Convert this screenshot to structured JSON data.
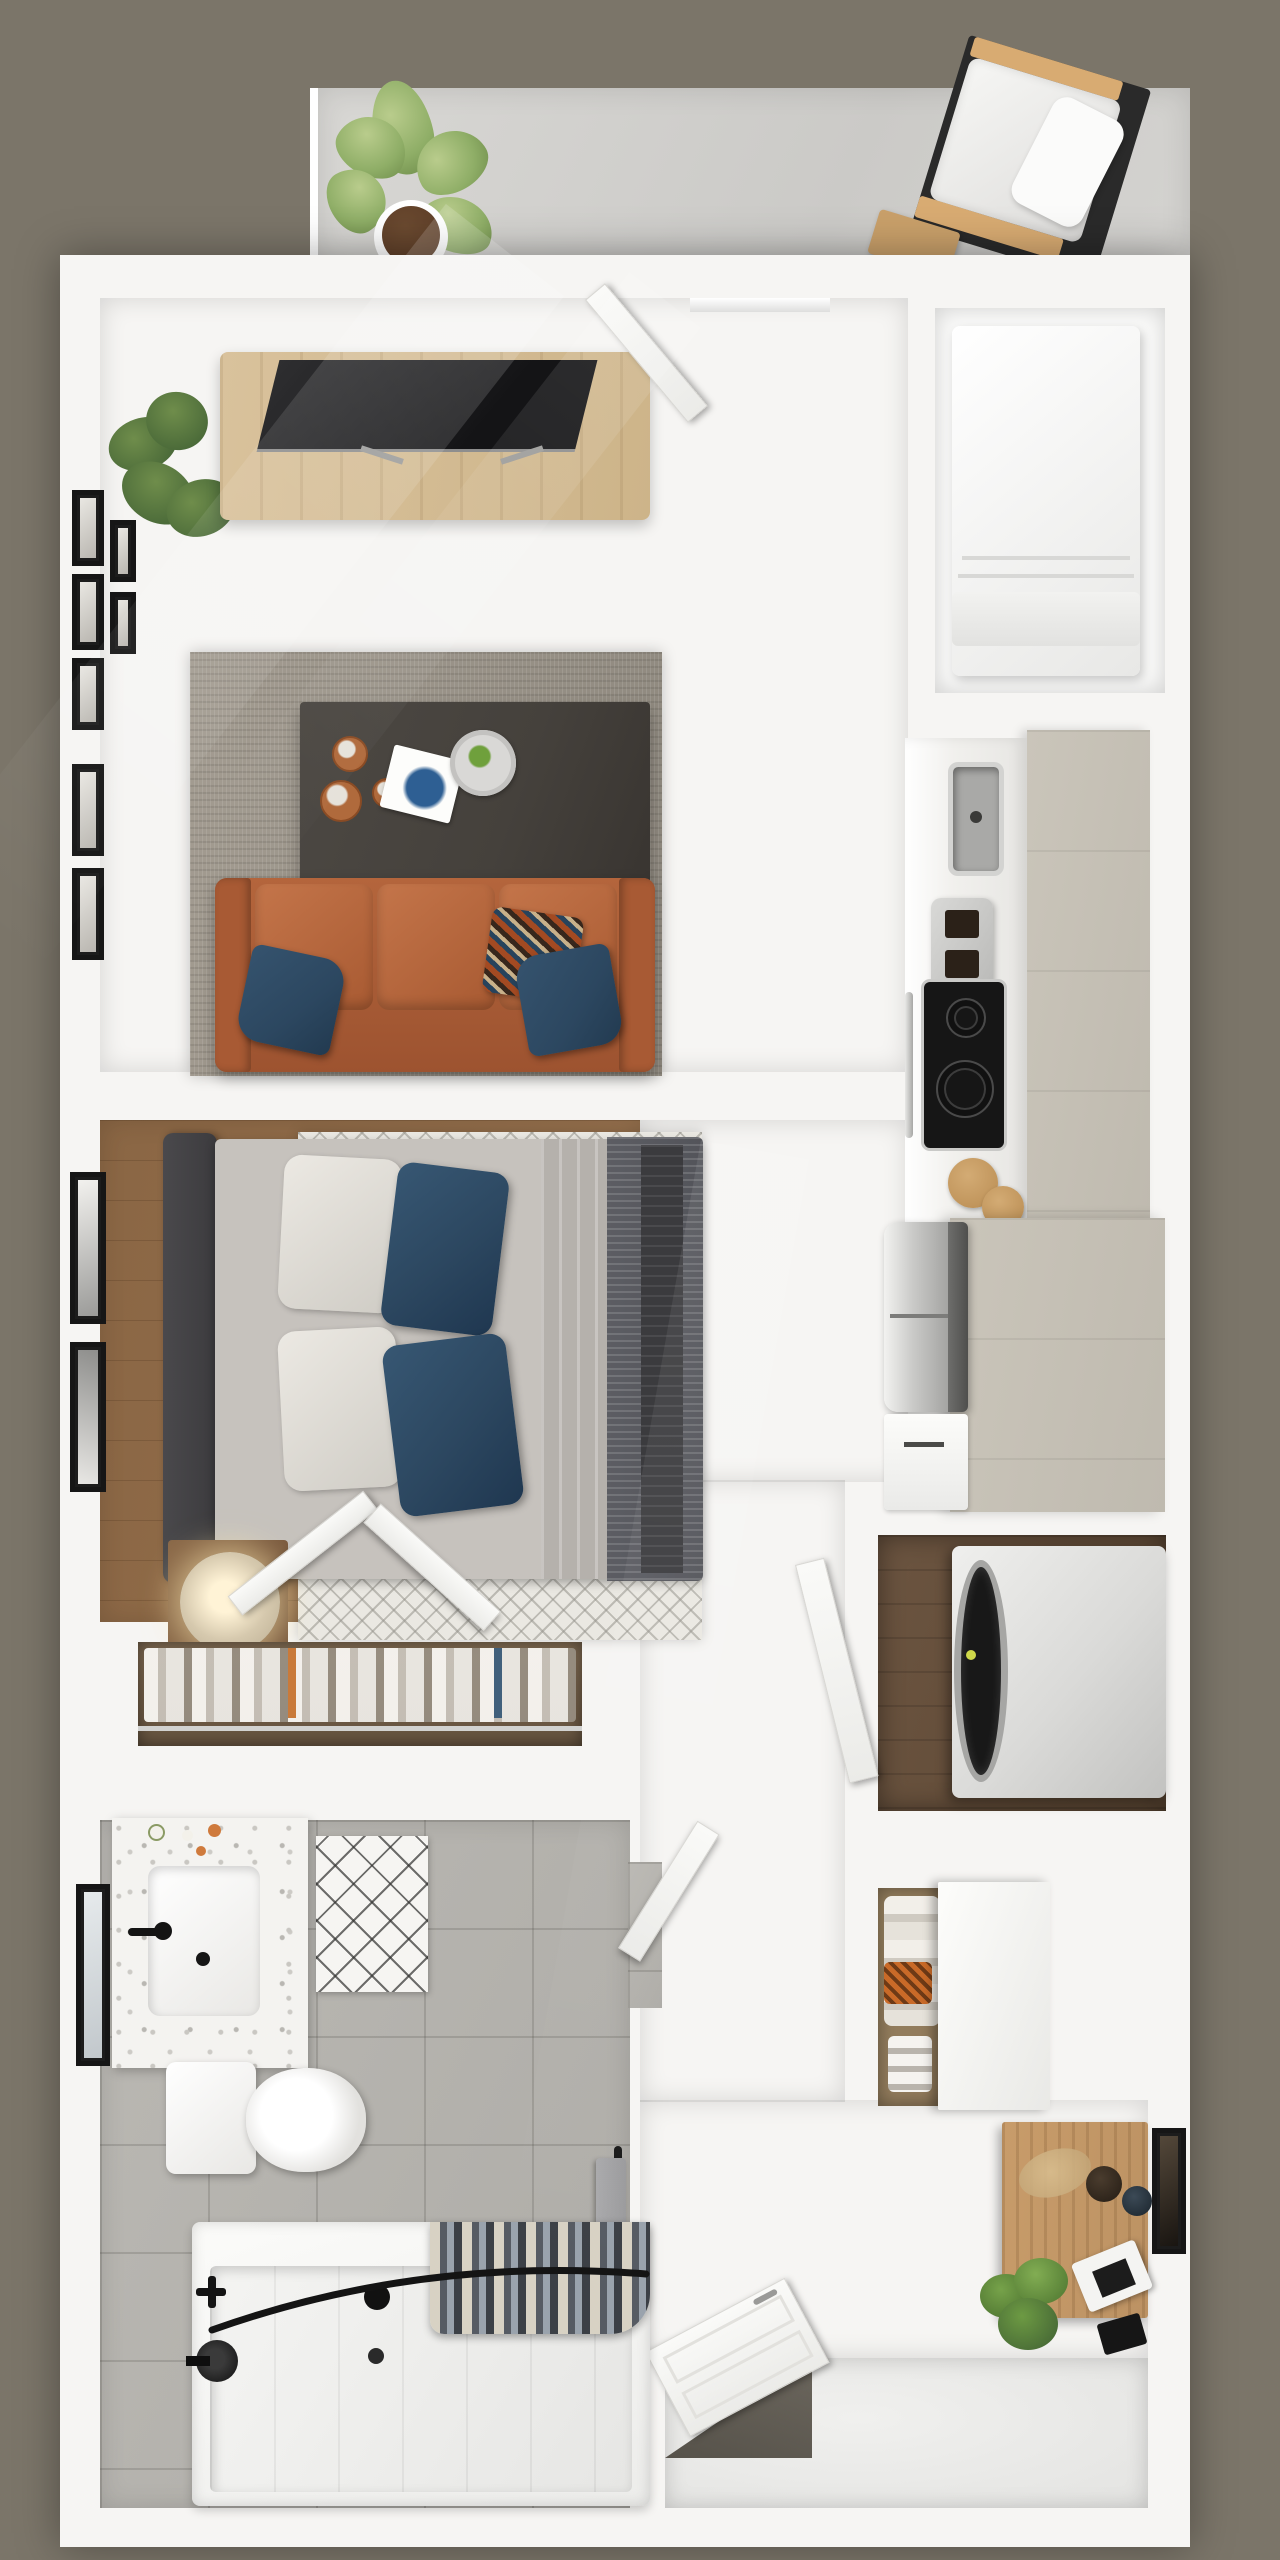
{
  "scene": {
    "kind": "3d-floor-plan-top-down-render",
    "unit_type": "studio apartment with balcony",
    "visible_text": "",
    "contents": [
      "balcony with concrete floor, monstera potted plant, outdoor lounge chair, wood side table",
      "living room with light oak floor, gallery wall frames, corner plant, media console with tv, gray shag rug, dark coffee table with copper mugs, book and plate, cognac leather sofa with navy and patterned pillows",
      "kitchen strip with marble counter, toaster, plate, sink, black cooktop, cutting boards, stainless fridge, taupe cabinets and pantry block, utility niche with white appliance",
      "bedroom with walnut floor, chevron rug, charcoal headboard, bed with white and navy pillows, striped dark duvet, glowing table lamp, two wall frames, open double closet doors",
      "wardrobe built-in with hanging clothes",
      "hallway with open white doors",
      "laundry closet with front-load washer dryer on dark wood floor",
      "coat closet with clothes, shoes and sliding panel",
      "entry area with wood desk, dried grass decor, black chair, potted plant, wall art",
      "entry nook with open paneled front door",
      "bathroom with terrazzo vanity, black faucet, mirror, toilet, diamond bath mat, gray tile floor, towel bar, bathtub with black curved curtain rod, striped shower curtain and black fixtures"
    ]
  },
  "palette": {
    "bg": "#7b7569",
    "wall": "#f6f5f3",
    "oak1": "#d2b888",
    "oak2": "#dcc8a2",
    "walnut": "#8a6644",
    "tile": "#bab8b3",
    "ruggray": "#a39c91",
    "rugchev": "#eae8e2",
    "taupe": "#cac5ba",
    "sofa": "#b4653c",
    "sofadark": "#9d5330",
    "navy": "#2c4760",
    "tabledark": "#45413c",
    "copper": "#b06a3c",
    "headboard": "#3c3b3e",
    "duvet": "#53545a",
    "throw": "#3b3b3e",
    "sheet": "#b5b1ac",
    "bedbase": "#c6c2bd",
    "marble": "#f1f0ed",
    "stainless": "#c6c6c4",
    "cooktop": "#161616",
    "washer": "#dadad8",
    "laundryfloor": "#5d4834",
    "closetback": "#8a7356",
    "terrazzo": "#f4f3f0",
    "towel": "#9b9b9d",
    "curtaincream": "#d8d2c4",
    "curtaindark": "#3c4046",
    "lamp": "#d6c9ae",
    "lampglow": "#fff3d6",
    "desk": "#bc9263",
    "plantlite": "#8fae67",
    "plantdark": "#3f5f33",
    "pot": "#5a3b26",
    "framecolor": "#1c1c1c",
    "threshold": "#56524a",
    "concrete": "#d5d4d1"
  }
}
